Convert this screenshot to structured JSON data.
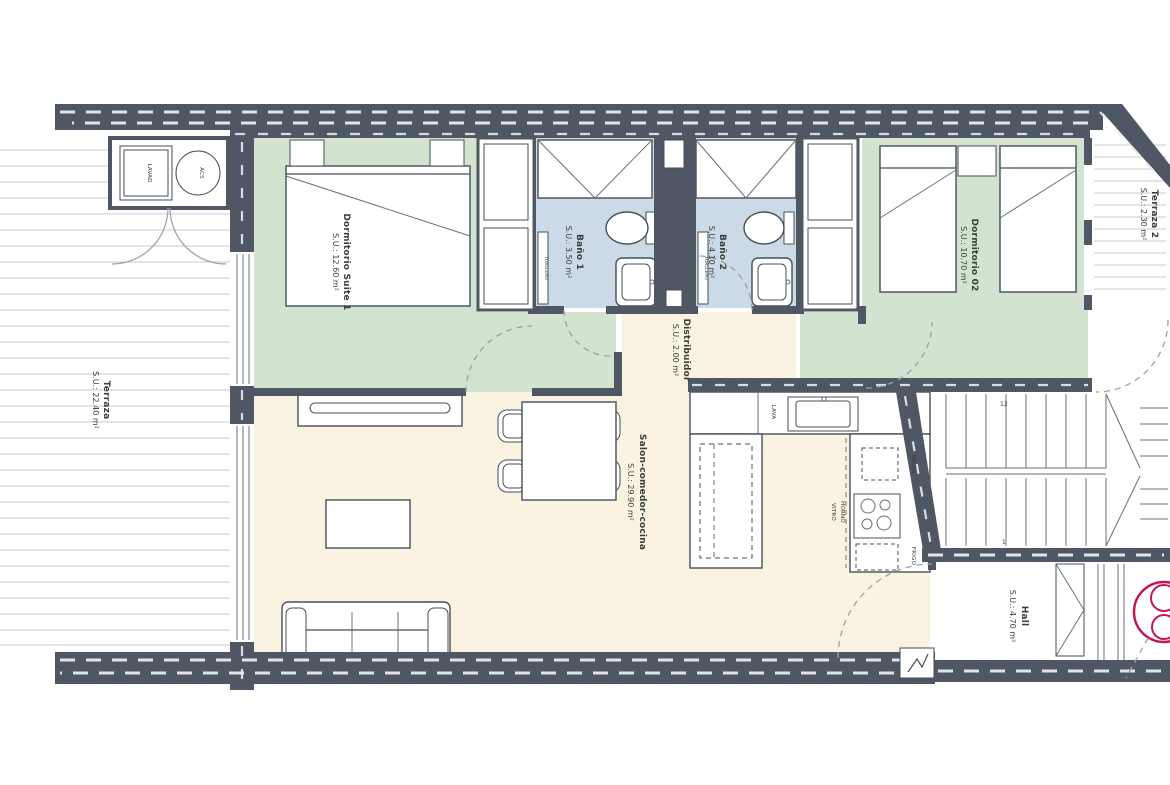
{
  "title": "Apartment floor plan",
  "rooms": {
    "terraza": {
      "name": "Terraza",
      "area": "S.U.: 22.40 m²"
    },
    "dormitorio_suite_1": {
      "name": "Dormitorio Suite 1",
      "area": "S.U.: 12.60 m²"
    },
    "bano_1": {
      "name": "Baño 1",
      "area": "S.U.: 3.50 m²"
    },
    "bano_2": {
      "name": "Baño 2",
      "area": "S.U.: 4.10 m²"
    },
    "dormitorio_02": {
      "name": "Dormitorio 02",
      "area": "S.U.: 10.70 m²"
    },
    "terraza_2": {
      "name": "Terraza 2",
      "area": "S.U.: 2.30 m²"
    },
    "distribuidor": {
      "name": "Distribuidor",
      "area": "S.U.: 2.00 m²"
    },
    "salon": {
      "name": "Salon-comedor-cocina",
      "area": "S.U.: 29.90 m²"
    },
    "hall": {
      "name": "Hall",
      "area": "S.U.: 4.70 m²"
    }
  },
  "labels": {
    "lavadora": "LAVAD",
    "acs": "ACS",
    "lava": "LAVA",
    "micro": "MICRO",
    "horno": "HORNO",
    "vitro": "VITRO",
    "frigo": "FRIGO",
    "toallero_1": "TOALLERO",
    "toallero_2": "TOALLERO",
    "stair_step_top": "12",
    "stair_step_bottom": "1"
  },
  "colors": {
    "wall": "#4e5763",
    "bedroom_fill": "#d2e4d0",
    "bathroom_fill": "#ccdae8",
    "living_fill": "#faf3e2",
    "deck_line": "#c9c9c9",
    "marker": "#c2185b"
  }
}
